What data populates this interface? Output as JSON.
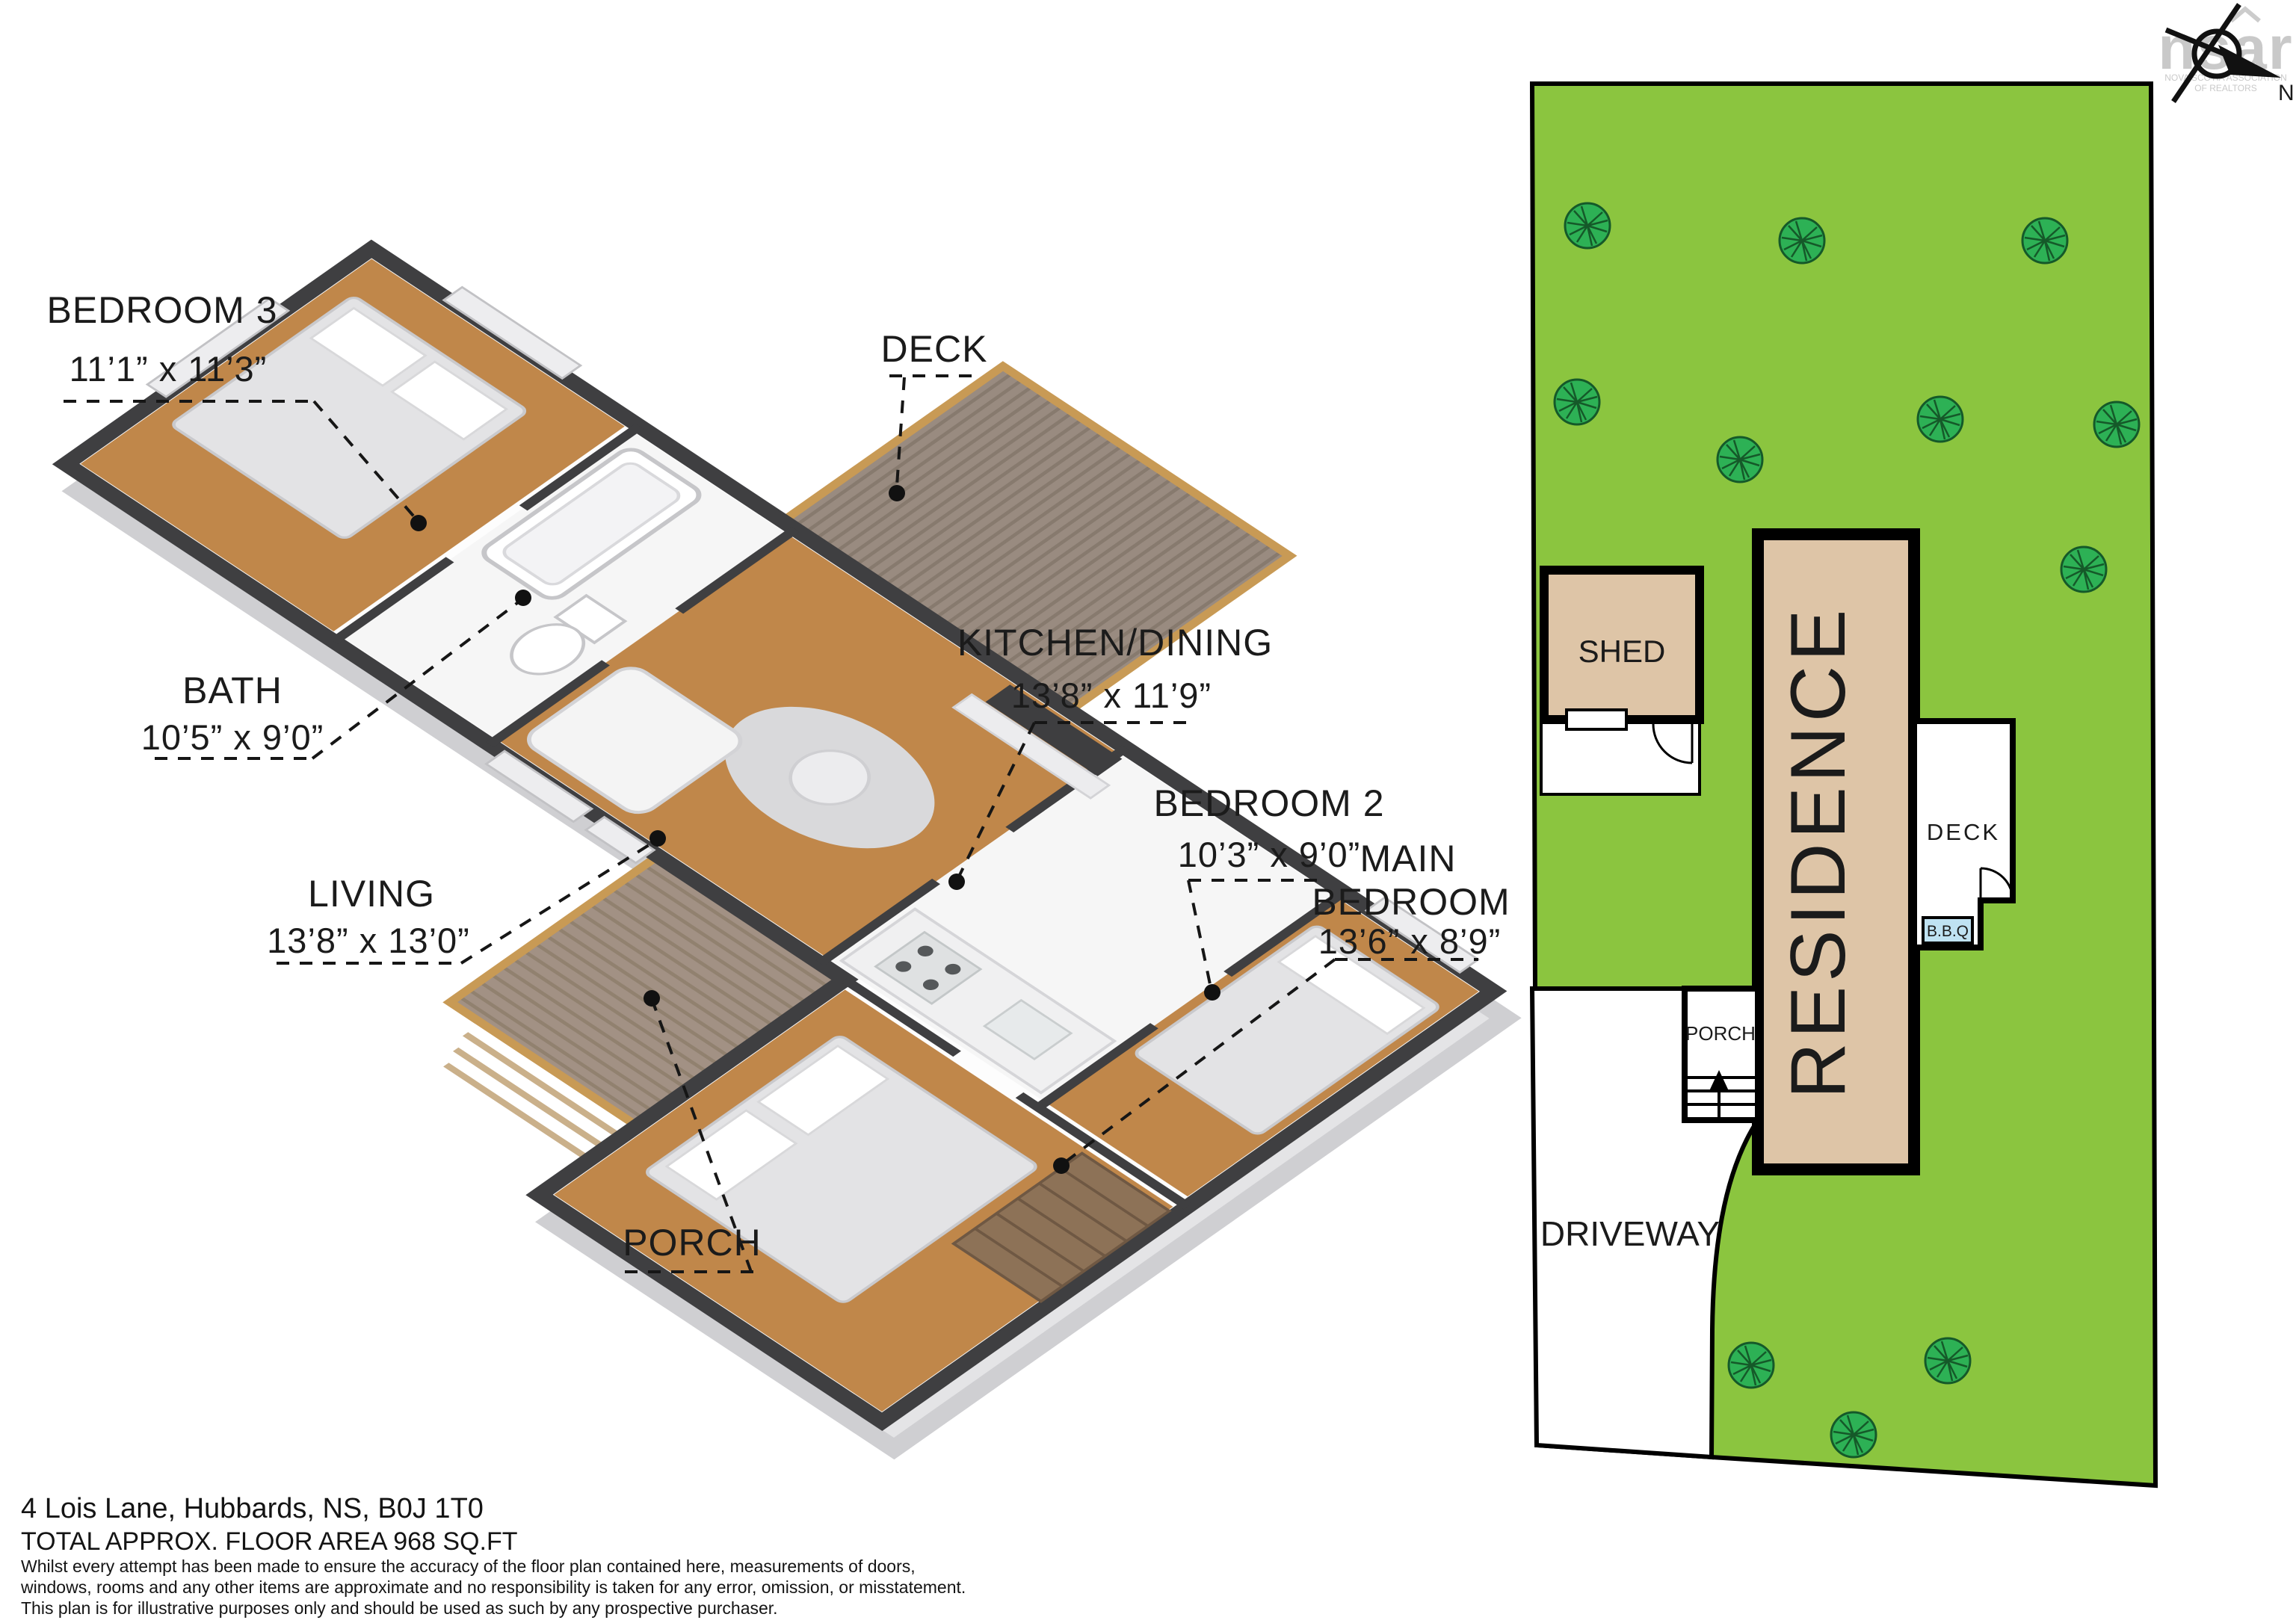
{
  "watermark": {
    "brand": "nsar",
    "caption_line1": "NOVA SCOTIA ASSOCIATION",
    "caption_line2": "OF REALTORS"
  },
  "compass": {
    "north_label": "N"
  },
  "floorplan": {
    "labels": {
      "bedroom3": {
        "name": "BEDROOM 3",
        "dims": "11’1” x 11’3”"
      },
      "deck": {
        "name": "DECK"
      },
      "bath": {
        "name": "BATH",
        "dims": "10’5” x 9’0”"
      },
      "living": {
        "name": "LIVING",
        "dims": "13’8” x 13’0”"
      },
      "kitchen_dining": {
        "name": "KITCHEN/DINING",
        "dims": "13’8” x 11’9”"
      },
      "bedroom2": {
        "name": "BEDROOM 2",
        "dims": "10’3” x 9’0”"
      },
      "main_bedroom": {
        "name_line1": "MAIN",
        "name_line2": "BEDROOM",
        "dims": "13’6” x 8’9”"
      },
      "porch": {
        "name": "PORCH"
      }
    }
  },
  "siteplan": {
    "shed_label": "SHED",
    "residence_label": "RESIDENCE",
    "deck_label": "DECK",
    "bbq_label": "B.B.Q",
    "porch_label": "PORCH",
    "driveway_label": "DRIVEWAY",
    "colors": {
      "lawn": "#8bc53f",
      "tree": "#2db155",
      "building": "#dec5a7",
      "bbq": "#bfe2f2"
    }
  },
  "footer": {
    "address": "4 Lois Lane, Hubbards, NS, B0J 1T0",
    "area": "TOTAL APPROX. FLOOR AREA 968 SQ.FT",
    "disclaimer_line1": "Whilst every attempt has been made to ensure the accuracy of the floor plan contained here, measurements of doors,",
    "disclaimer_line2": "windows, rooms and any other items are approximate and no responsibility is taken for any error, omission, or misstatement.",
    "disclaimer_line3": "This plan is for illustrative purposes only and should be used as such by any prospective purchaser."
  }
}
